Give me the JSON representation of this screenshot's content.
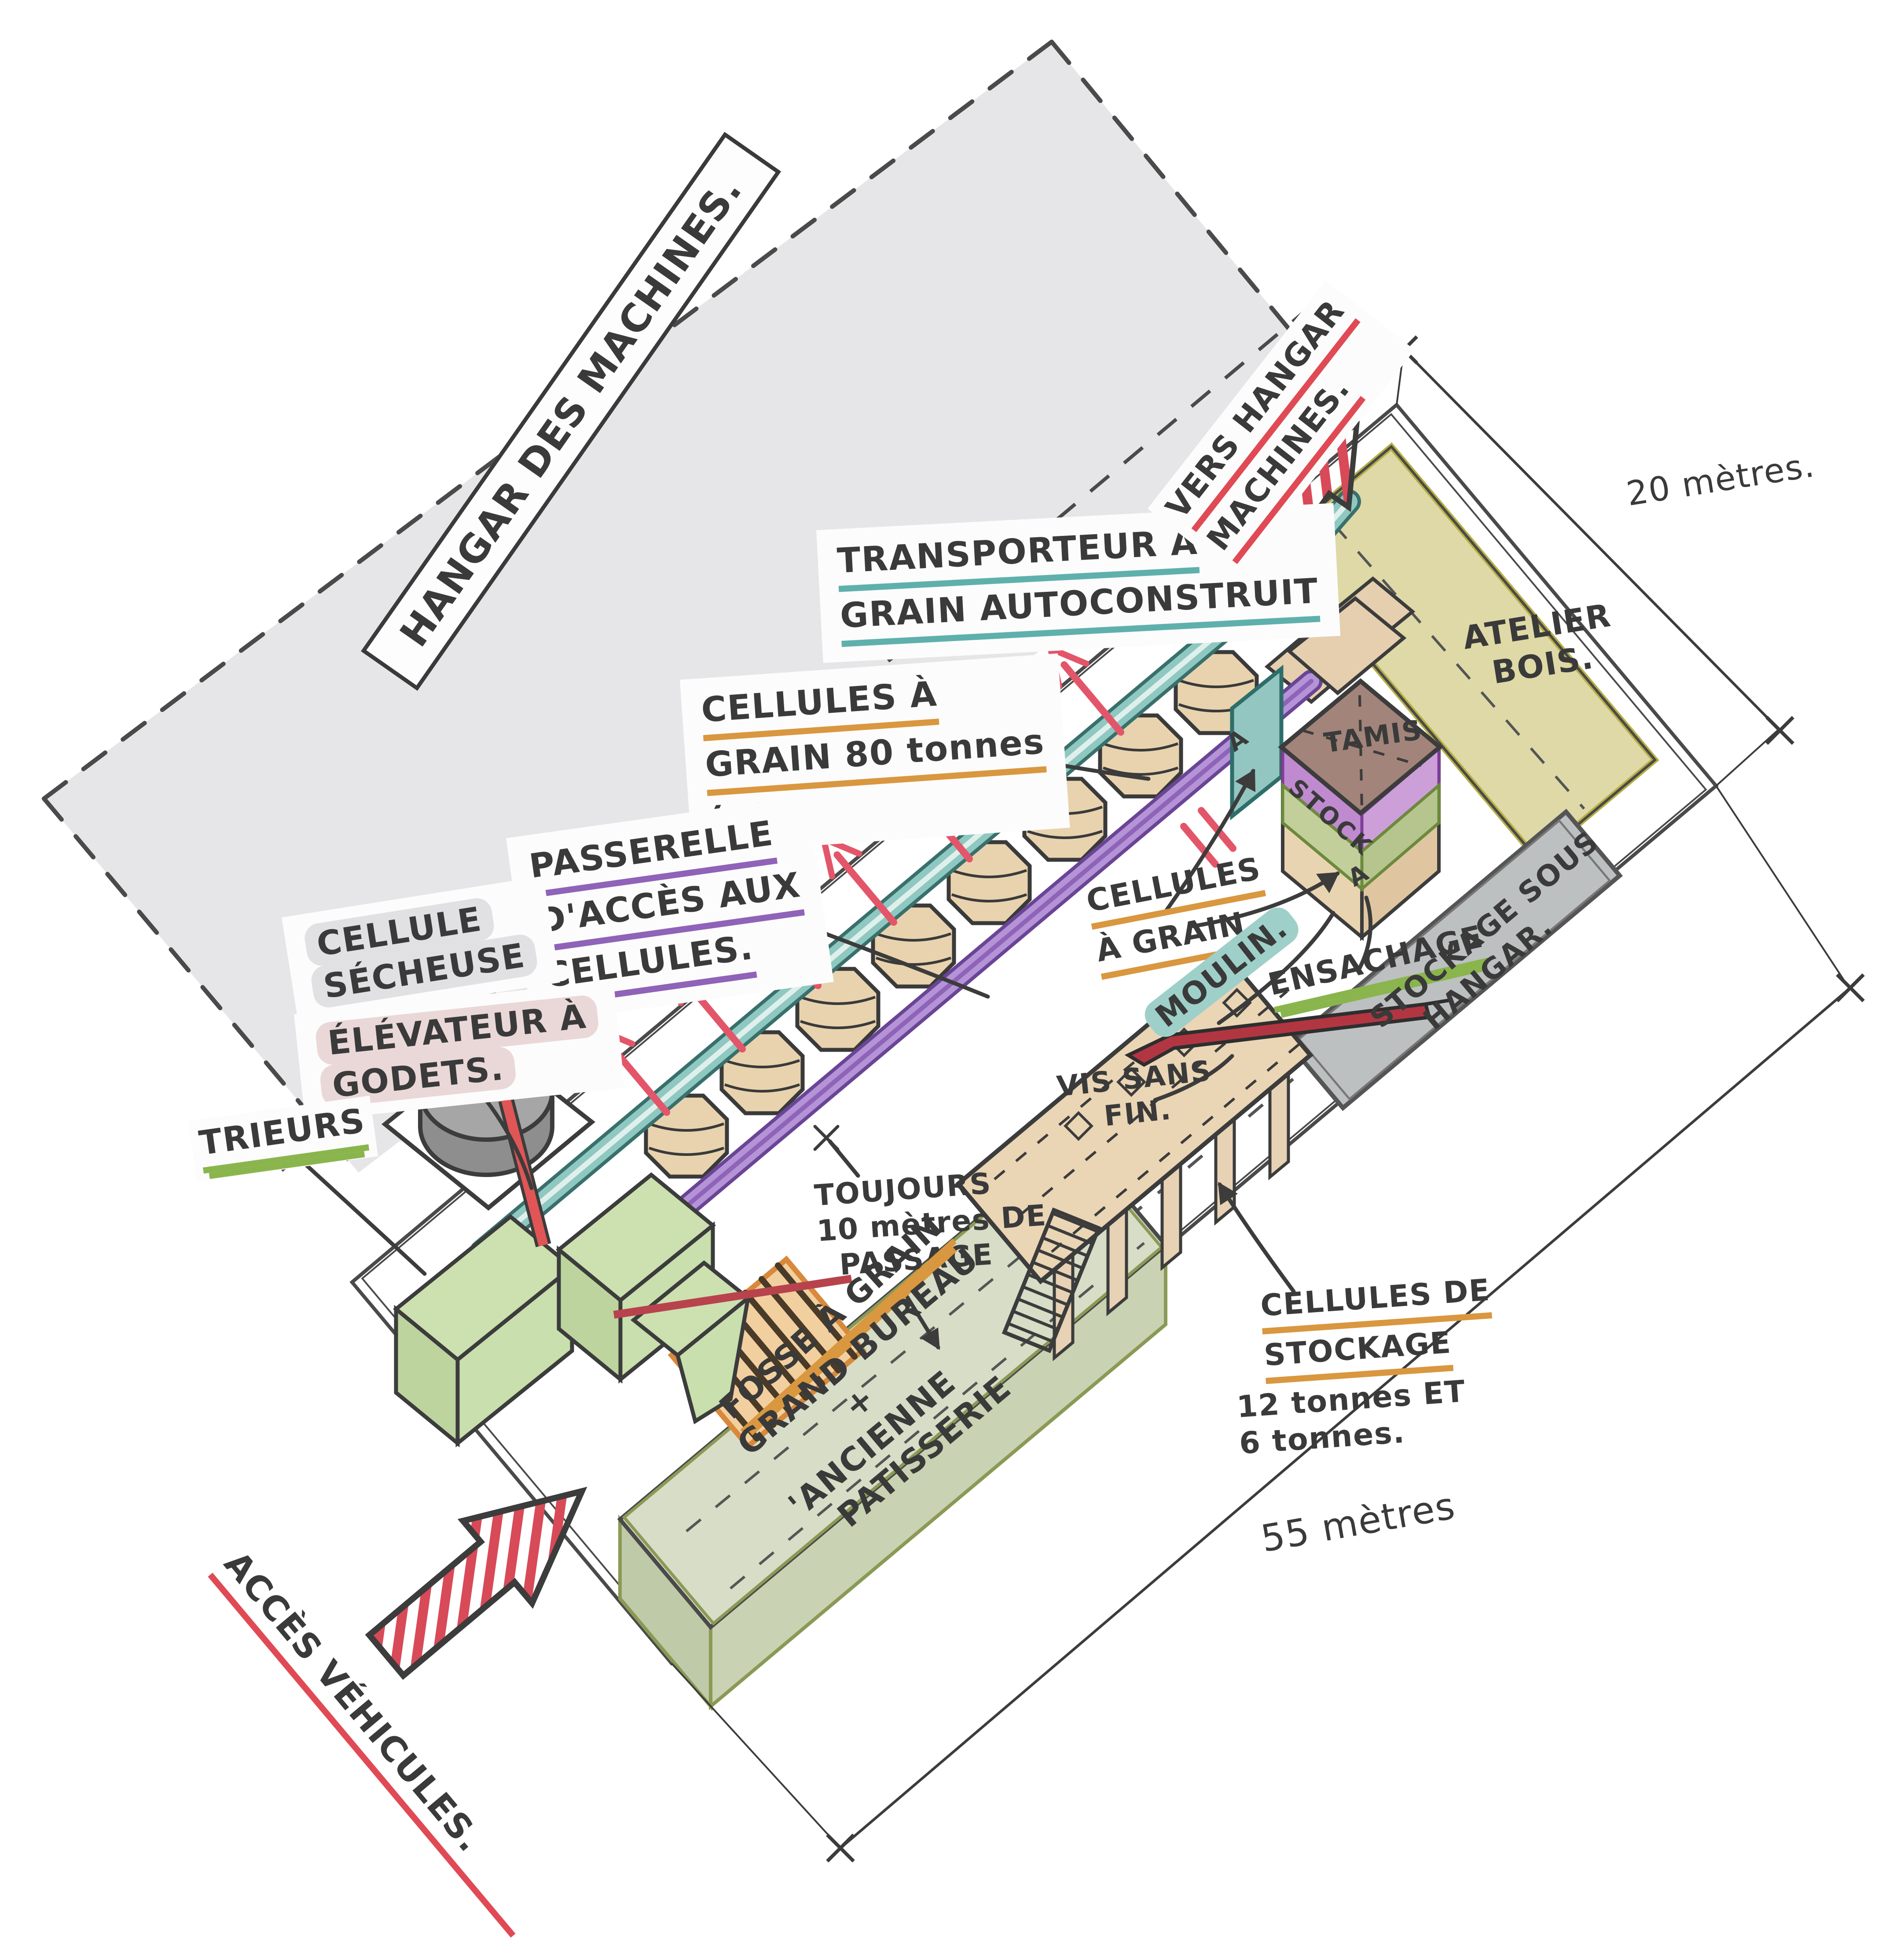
{
  "colors": {
    "paper": "#ffffff",
    "hangar_zone": "#e6e6e8",
    "site_outline": "#4a4a4a",
    "atelier_fill": "#ded9a6",
    "shed_fill": "#bdc0c0",
    "bureau_fill": "#d7ddc6",
    "silo_fill": "#e8d3ae",
    "conveyor_teal": "#8fc7c1",
    "walkway_purple": "#b493d6",
    "tamis_brown": "#a2847a",
    "stock_purple": "#c08ad0",
    "band_green": "#c2cf9b",
    "machine_green": "#cde0b0",
    "fosse_fill": "#f2cf9f",
    "cylinder_gray": "#9b9b9b",
    "accent_red": "#e04a55",
    "underline_teal": "#5fb0ac",
    "underline_orange": "#d9973f",
    "underline_purple": "#8f63b8",
    "underline_green": "#8ab54d",
    "underline_red": "#e04a55"
  },
  "labels": {
    "hangar_machines": "HANGAR DES MACHINES.",
    "transporteur": {
      "lines": [
        "TRANSPORTEUR À",
        "GRAIN AUTOCONSTRUIT"
      ]
    },
    "cellules_grain_80": {
      "lines": [
        "CELLULES À",
        "GRAIN 80 tonnes",
        "(x8)."
      ]
    },
    "passerelle": {
      "lines": [
        "PASSERELLE",
        "D'ACCÈS AUX",
        "CELLULES."
      ]
    },
    "cellule_secheuse": {
      "lines": [
        "CELLULE",
        "SÉCHEUSE"
      ]
    },
    "elevateur_godets": {
      "lines": [
        "ÉLÉVATEUR À",
        "GODETS."
      ]
    },
    "trieurs": "TRIEURS",
    "vers_hangar": {
      "lines": [
        "VERS HANGAR",
        "MACHINES."
      ]
    },
    "atelier_bois": {
      "lines": [
        "ATELIER",
        "BOIS."
      ]
    },
    "tamis": "TAMIS",
    "stock": "STOCK",
    "cellules_a_grain": {
      "lines": [
        "CELLULES",
        "À GRAIN."
      ]
    },
    "moulin": "MOULIN.",
    "ensachage": "ENSACHAGE",
    "stockage_sous_hangar": {
      "lines": [
        "STOCKAGE SOUS",
        "HANGAR."
      ]
    },
    "vis_sans_fin": {
      "lines": [
        "VIS SANS",
        "FIN."
      ]
    },
    "toujours_passage": {
      "lines": [
        "TOUJOURS",
        "10 mètres DE",
        "PASSAGE"
      ]
    },
    "fosse_a_grain": "FOSSE À GRAIN",
    "grand_bureau": {
      "lines": [
        "GRAND BUREAU",
        "+",
        "'ANCIENNE",
        "PATISSERIE"
      ]
    },
    "cellules_stockage": {
      "lines": [
        "CELLULES DE",
        "STOCKAGE",
        "12 tonnes ET",
        "6 tonnes."
      ]
    },
    "acces_vehicules": "ACCÈS VÉHICULES.",
    "marker_a": "A"
  },
  "dimensions": {
    "width": "20 mètres.",
    "length": "55 mètres"
  }
}
